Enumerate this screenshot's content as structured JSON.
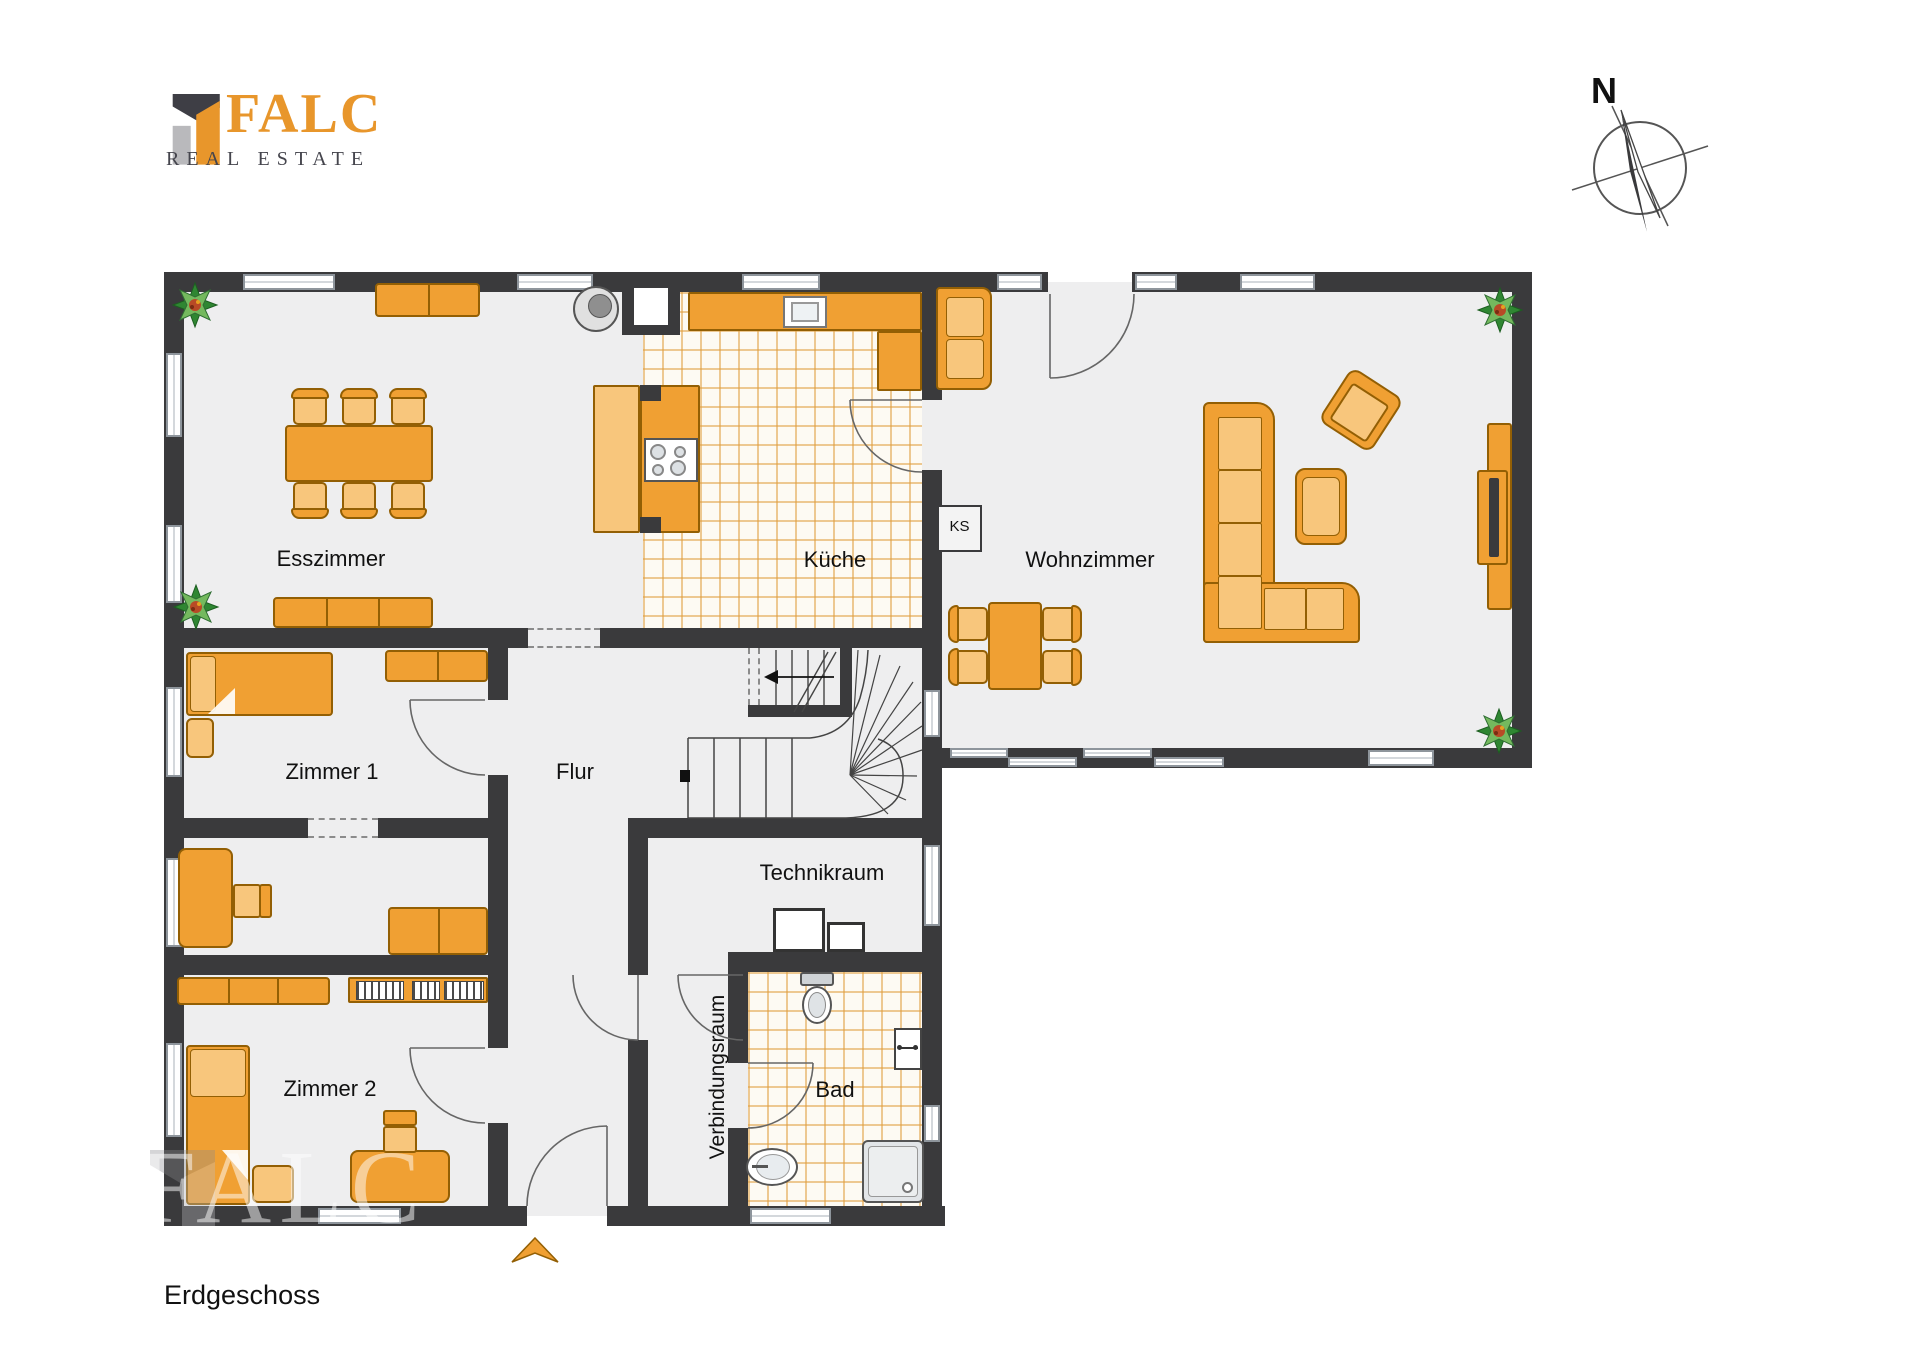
{
  "logo": {
    "name": "FALC",
    "tagline": "REAL ESTATE"
  },
  "compass": {
    "label": "N"
  },
  "floor": {
    "label": "Erdgeschoss"
  },
  "rooms": {
    "esszimmer": "Esszimmer",
    "kueche": "Küche",
    "wohnzimmer": "Wohnzimmer",
    "zimmer1": "Zimmer 1",
    "flur": "Flur",
    "technikraum": "Technikraum",
    "zimmer2": "Zimmer 2",
    "verbindungsraum": "Verbindungsraum",
    "bad": "Bad"
  },
  "appliances": {
    "ks": "KS"
  },
  "watermark": {
    "text": "FALC"
  },
  "colors": {
    "wall": "#3A3A3C",
    "floor": "#EEEEEF",
    "furniture_orange": "#F0A033",
    "furniture_light": "#F8C67C",
    "tile_line": "#E09E40",
    "logo_orange": "#E8962B",
    "logo_gray": "#45454D"
  }
}
